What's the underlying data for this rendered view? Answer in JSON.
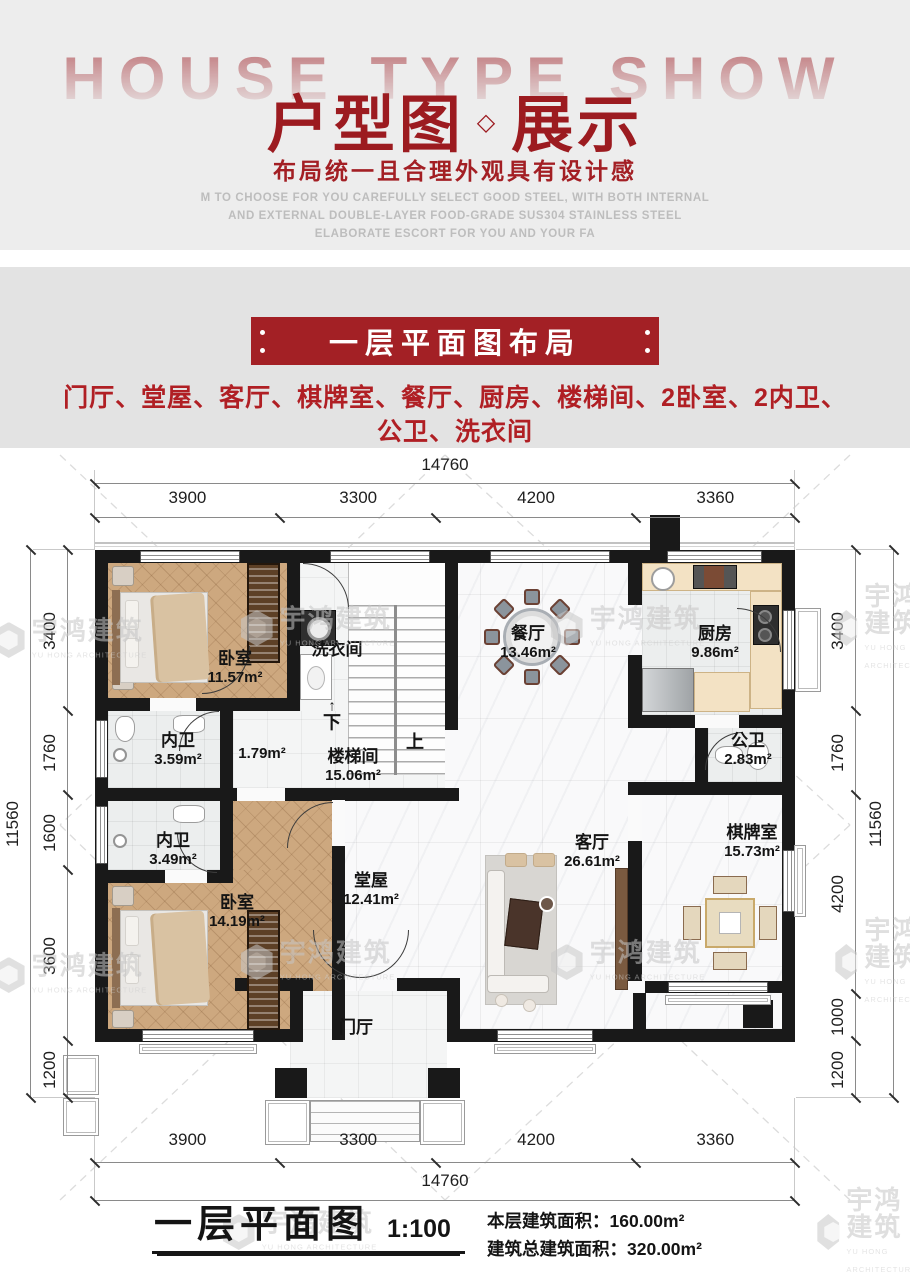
{
  "colors": {
    "accent_red": "#9c1b20",
    "banner_red": "#a32025",
    "desc_red": "#b01f24",
    "wall_black": "#191919"
  },
  "header": {
    "ghost_title": "HOUSE TYPE SHOW",
    "title_part1": "户型图",
    "title_diamond": "◇",
    "title_part2": "展示",
    "subtitle": "布局统一且合理外观具有设计感",
    "english_lines": [
      "M TO CHOOSE FOR YOU CAREFULLY SELECT GOOD STEEL, WITH BOTH INTERNAL",
      "AND EXTERNAL DOUBLE-LAYER FOOD-GRADE SUS304 STAINLESS STEEL",
      "ELABORATE ESCORT FOR YOU AND YOUR FA"
    ]
  },
  "section": {
    "banner_title": "一层平面图布局",
    "desc_line1": "门厅、堂屋、客厅、棋牌室、餐厅、厨房、楼梯间、2卧室、2内卫、",
    "desc_line2": "公卫、洗衣间"
  },
  "plan": {
    "rooms": [
      {
        "id": "bedroom1",
        "label": "卧室",
        "area": "11.57m²"
      },
      {
        "id": "laundry",
        "label": "洗衣间",
        "area": ""
      },
      {
        "id": "bath1",
        "label": "内卫",
        "area": "3.59m²"
      },
      {
        "id": "hall_small",
        "label": "",
        "area": "1.79m²"
      },
      {
        "id": "stairwell",
        "label": "楼梯间",
        "area": "15.06m²"
      },
      {
        "id": "dining",
        "label": "餐厅",
        "area": "13.46m²"
      },
      {
        "id": "kitchen",
        "label": "厨房",
        "area": "9.86m²"
      },
      {
        "id": "bath_public",
        "label": "公卫",
        "area": "2.83m²"
      },
      {
        "id": "bath2",
        "label": "内卫",
        "area": "3.49m²"
      },
      {
        "id": "bedroom2",
        "label": "卧室",
        "area": "14.19m²"
      },
      {
        "id": "hall_main",
        "label": "堂屋",
        "area": "12.41m²"
      },
      {
        "id": "living",
        "label": "客厅",
        "area": "26.61m²"
      },
      {
        "id": "chess",
        "label": "棋牌室",
        "area": "15.73m²"
      },
      {
        "id": "foyer",
        "label": "门厅",
        "area": ""
      }
    ],
    "stair_down": "下",
    "stair_up": "上",
    "stair_arrow": "↑",
    "dims": {
      "top_overall": "14760",
      "top_segments": [
        "3900",
        "3300",
        "4200",
        "3360"
      ],
      "bottom_overall": "14760",
      "bottom_segments": [
        "3900",
        "3300",
        "4200",
        "3360"
      ],
      "left_overall": "11560",
      "left_segments": [
        "3400",
        "1760",
        "1600",
        "3600",
        "1200"
      ],
      "right_overall": "11560",
      "right_segments": [
        "3400",
        "1760",
        "4200",
        "1000",
        "1200"
      ]
    }
  },
  "footer": {
    "title": "一层平面图",
    "scale": "1:100",
    "area_line1": "本层建筑面积：160.00m²",
    "area_line2": "建筑总建筑面积：320.00m²"
  },
  "watermark": {
    "cn": "宇鸿建筑",
    "en": "YU HONG ARCHITECTURE"
  }
}
